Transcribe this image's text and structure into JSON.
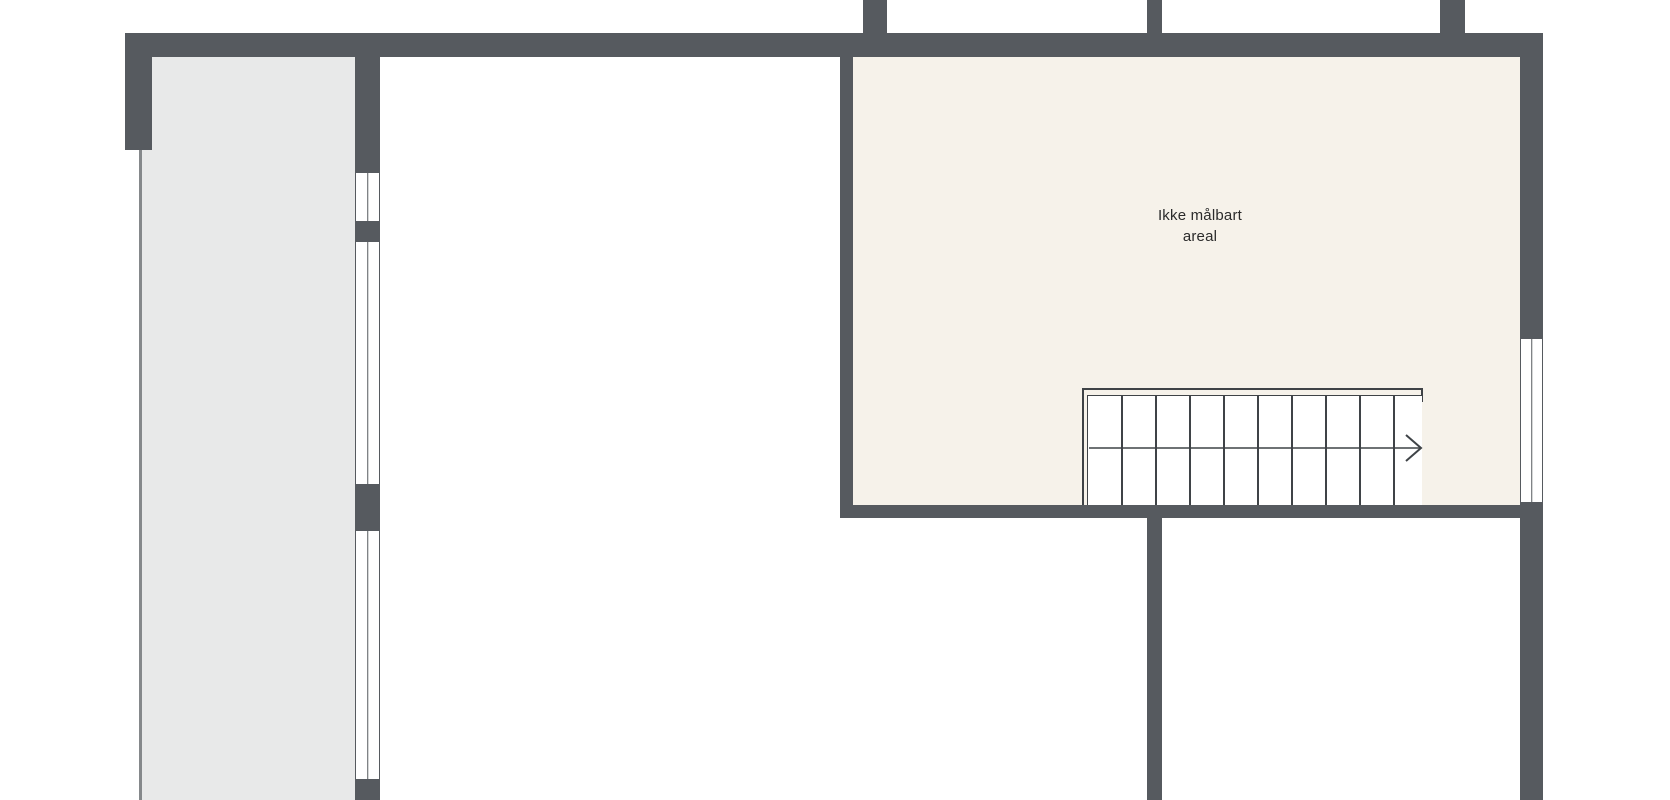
{
  "palette": {
    "background": "#ffffff",
    "wall": "#565a5f",
    "room_gray": "#e8e9e9",
    "room_cream": "#f6f2ea",
    "thin_line": "#85888b",
    "stair_line": "#3f4347",
    "window_fill": "#ffffff",
    "text": "#2b2b2b"
  },
  "rooms": [
    {
      "name": "side-room",
      "fill_key": "room_gray",
      "rect": [
        141,
        57,
        214,
        743
      ]
    },
    {
      "name": "unmeasurable-area",
      "fill_key": "room_cream",
      "rect": [
        853,
        57,
        667,
        448
      ],
      "label_line1": "Ikke målbart",
      "label_line2": "areal"
    }
  ],
  "walls": [
    {
      "name": "wall-top-exterior",
      "rect": [
        125,
        33,
        1418,
        24
      ]
    },
    {
      "name": "wall-left-exterior",
      "rect": [
        125,
        33,
        27,
        117
      ]
    },
    {
      "name": "wall-stub-left",
      "rect": [
        863,
        0,
        24,
        35
      ]
    },
    {
      "name": "wall-stub-middle",
      "rect": [
        1147,
        0,
        15,
        36
      ]
    },
    {
      "name": "wall-stub-right",
      "rect": [
        1440,
        0,
        25,
        35
      ]
    },
    {
      "name": "wall-divider-upper",
      "rect": [
        355,
        57,
        25,
        115
      ]
    },
    {
      "name": "wall-divider-mid",
      "rect": [
        355,
        222,
        25,
        19
      ]
    },
    {
      "name": "wall-divider-lower",
      "rect": [
        355,
        485,
        25,
        45
      ]
    },
    {
      "name": "wall-divider-bottom",
      "rect": [
        355,
        780,
        25,
        20
      ]
    },
    {
      "name": "wall-room-left",
      "rect": [
        840,
        57,
        13,
        461
      ]
    },
    {
      "name": "wall-room-bottom",
      "rect": [
        840,
        505,
        703,
        13
      ]
    },
    {
      "name": "wall-center-lower",
      "rect": [
        1147,
        518,
        15,
        282
      ]
    },
    {
      "name": "wall-right-upper",
      "rect": [
        1520,
        57,
        23,
        281
      ]
    },
    {
      "name": "wall-right-lower",
      "rect": [
        1520,
        503,
        23,
        297
      ]
    }
  ],
  "boundary_line": {
    "name": "side-room-open-boundary",
    "rect": [
      139,
      150,
      2.5,
      650
    ]
  },
  "windows": [
    {
      "name": "window-divider-top",
      "rect": [
        355,
        172,
        25,
        50
      ],
      "orient": "v"
    },
    {
      "name": "window-divider-middle",
      "rect": [
        355,
        241,
        25,
        244
      ],
      "orient": "v"
    },
    {
      "name": "window-divider-bottom",
      "rect": [
        355,
        530,
        25,
        250
      ],
      "orient": "v"
    },
    {
      "name": "window-right-wall",
      "rect": [
        1520,
        338,
        23,
        165
      ],
      "orient": "v"
    }
  ],
  "stair": {
    "outer": [
      1082,
      388,
      341,
      117
    ],
    "outer_right_tick": [
      1421,
      388,
      2,
      14
    ],
    "tread_area": [
      1087,
      395,
      335,
      110
    ],
    "tread_lines_x": [
      1121,
      1155,
      1189,
      1223,
      1257,
      1291,
      1325,
      1359,
      1393
    ],
    "walk_line_y": 448,
    "direction": "right"
  }
}
